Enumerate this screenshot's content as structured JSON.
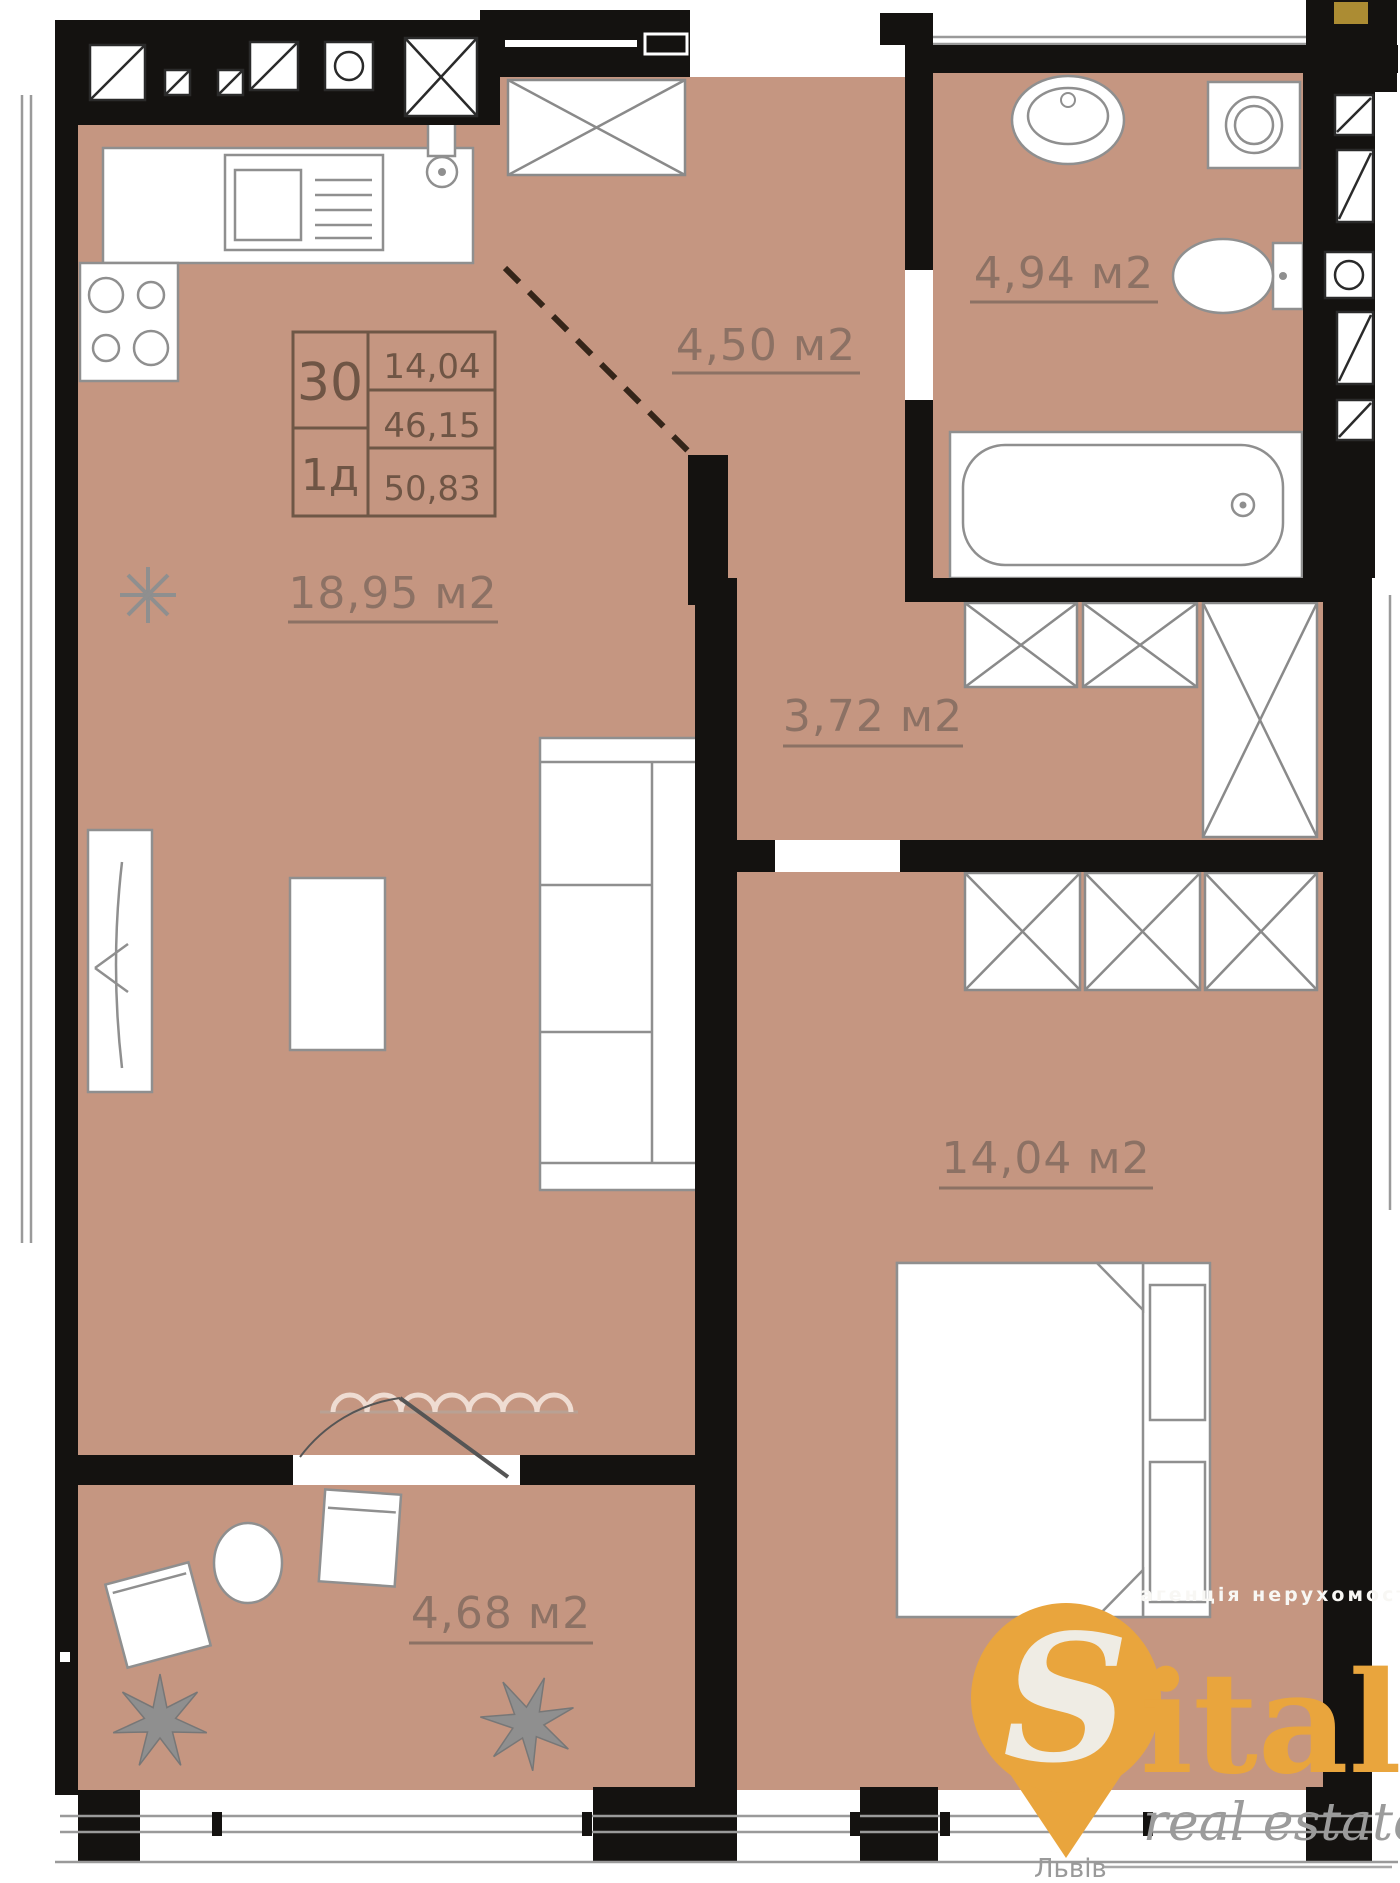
{
  "info_box": {
    "unit_number": "30",
    "unit_type": "1д",
    "rows": [
      "14,04",
      "46,15",
      "50,83"
    ]
  },
  "rooms": {
    "kitchen_living": {
      "area": "18,95 м2"
    },
    "entry_hall": {
      "area": "4,50 м2"
    },
    "bathroom": {
      "area": "4,94 м2"
    },
    "hallway": {
      "area": "3,72 м2"
    },
    "bedroom": {
      "area": "14,04 м2"
    },
    "balcony": {
      "area": "4,68 м2"
    }
  },
  "watermark": {
    "agency_line": "агенція нерухомості",
    "brand_initial": "S",
    "brand_rest": "italo",
    "tagline": "real estate",
    "city": "Львів"
  },
  "colors": {
    "floor": "#c59681",
    "wall": "#141210",
    "label": "#8c7164",
    "accent_orange": "#e9a53d",
    "fixture_outline": "#8f8f8f",
    "script_gray": "#9b9b9b",
    "agency_white": "#f8f7f4"
  }
}
